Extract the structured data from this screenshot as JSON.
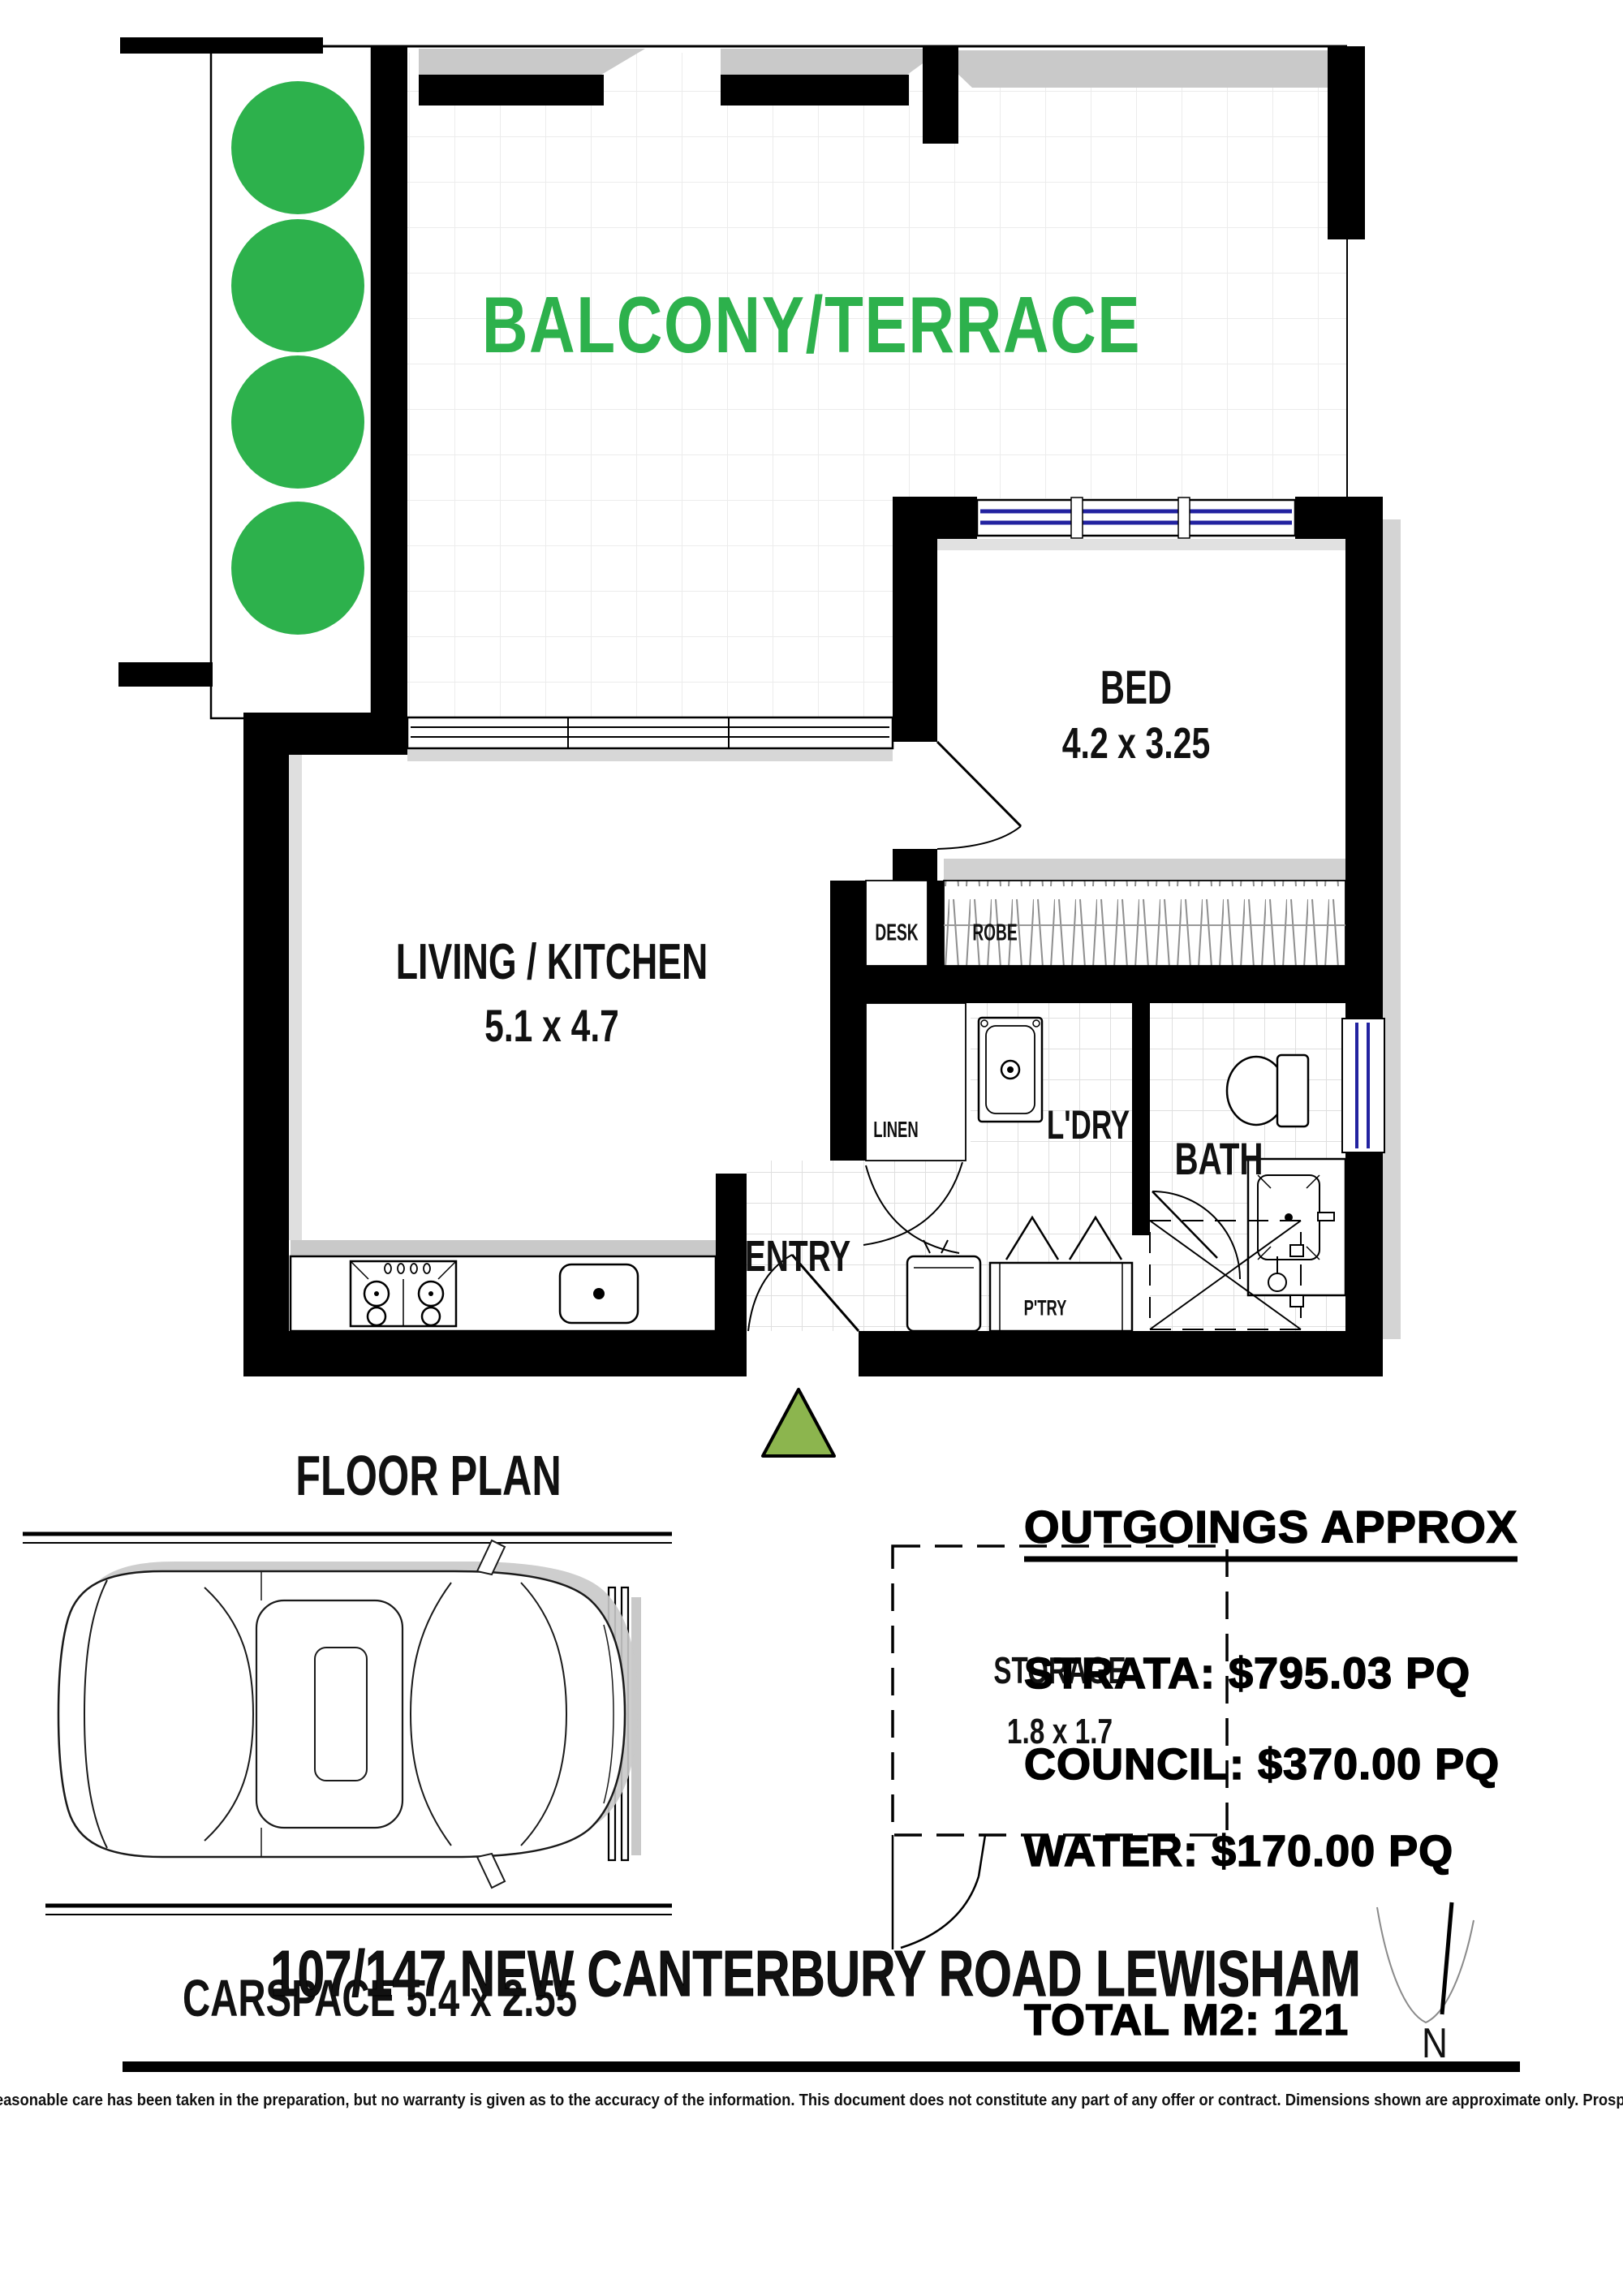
{
  "colors": {
    "label_green": "#2db14c",
    "entry_triangle_green": "#8cb54e",
    "window_blue": "#2222a0"
  },
  "floor_plan": {
    "title": "FLOOR PLAN",
    "balcony_label": "BALCONY/TERRACE",
    "rooms": {
      "bed": {
        "label": "BED",
        "dims": "4.2 x 3.25"
      },
      "living": {
        "label": "LIVING / KITCHEN",
        "dims": "5.1 x 4.7"
      },
      "desk": "DESK",
      "robe": "ROBE",
      "linen": "LINEN",
      "ldry": "L'DRY",
      "bath": "BATH",
      "entry": "ENTRY",
      "ptry": "P'TRY"
    }
  },
  "carspace": {
    "label": "CARSPACE 5.4 x 2.55"
  },
  "storage": {
    "label": "STORAGE",
    "dims": "1.8 x 1.7"
  },
  "outgoings": {
    "title": "OUTGOINGS APPROX",
    "strata": "STRATA: $795.03 PQ",
    "council": "COUNCIL: $370.00 PQ",
    "water": "WATER: $170.00 PQ",
    "total": "TOTAL M2: 121"
  },
  "address": "107/147 NEW CANTERBURY ROAD LEWISHAM",
  "compass": {
    "north": "N"
  },
  "disclaimer": "This diagram is for illustrative purpose only. All reasonable care has been taken in the preparation, but no warranty is given as to the accuracy of the information. This document does not constitute any part of any offer or contract. Dimensions shown are approximate only. Prospective purchasers must rely on their own enquiries."
}
